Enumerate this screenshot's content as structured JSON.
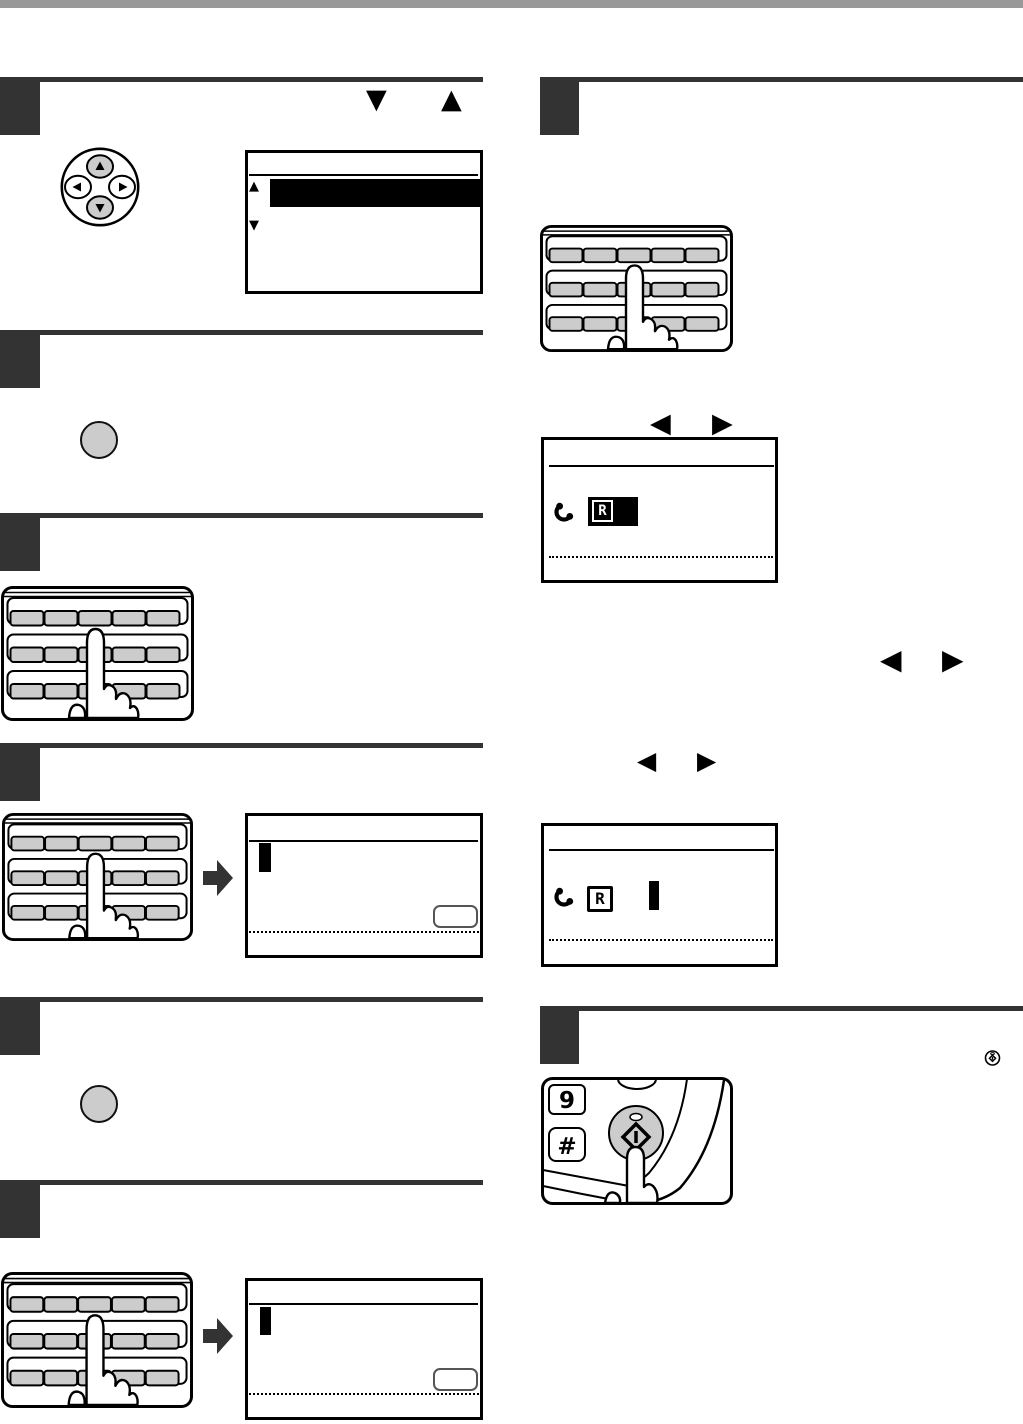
{
  "page": {
    "background": "#ffffff",
    "top_bar_color": "#999999",
    "step_marker_color": "#333333",
    "key_fill_color": "#cccccc",
    "line_color": "#000000"
  },
  "icons": {
    "triangle_up": "▲",
    "triangle_down": "▼",
    "triangle_left": "◀",
    "triangle_right": "▶",
    "phone_handset": "handset-glyph",
    "start_key": "diamond-in-circle"
  },
  "labels": {
    "r_symbol": "R",
    "r_symbol_selected": "R",
    "digit_nine_key": "9",
    "hash_key": "#"
  }
}
